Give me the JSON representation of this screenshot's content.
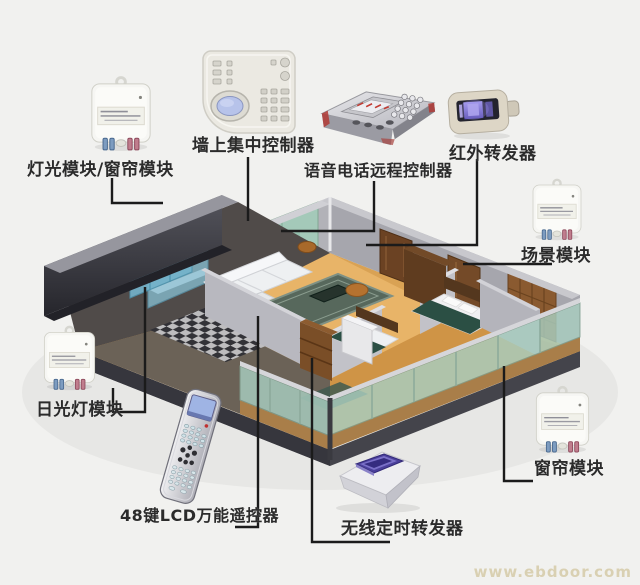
{
  "page": {
    "watermark": "www.ebdoor.com",
    "background_color": "#f1f1ef",
    "callout_line_color": "#1b1b1b"
  },
  "devices": [
    {
      "id": "light-curtain-module",
      "label": "灯光模块/窗帘模块",
      "type": "plug-module"
    },
    {
      "id": "wall-controller",
      "label": "墙上集中控制器",
      "type": "wall-panel"
    },
    {
      "id": "voice-phone-controller",
      "label": "语音电话远程控制器",
      "type": "telephone-remote-box"
    },
    {
      "id": "ir-repeater",
      "label": "红外转发器",
      "type": "infrared-repeater"
    },
    {
      "id": "scene-module",
      "label": "场景模块",
      "type": "plug-module"
    },
    {
      "id": "fluorescent-module",
      "label": "日光灯模块",
      "type": "plug-module"
    },
    {
      "id": "remote-48key",
      "label": "48键LCD万能遥控器",
      "type": "remote-control"
    },
    {
      "id": "wireless-timer",
      "label": "无线定时转发器",
      "type": "timer-repeater"
    },
    {
      "id": "curtain-module",
      "label": "窗帘模块",
      "type": "plug-module"
    }
  ],
  "colors": {
    "glass_green": "#a9cec0",
    "glass_blue": "#7fbcd4",
    "wood_floor": "#d9a254",
    "wall_light": "#b2b2b8",
    "wall_dark": "#3c3c42",
    "module_plug_blue": "#7d9cc0",
    "module_plug_red": "#c07d8d",
    "ir_screen_purple": "#8a7fe0",
    "timer_slot_purple": "#4a3f9a"
  }
}
